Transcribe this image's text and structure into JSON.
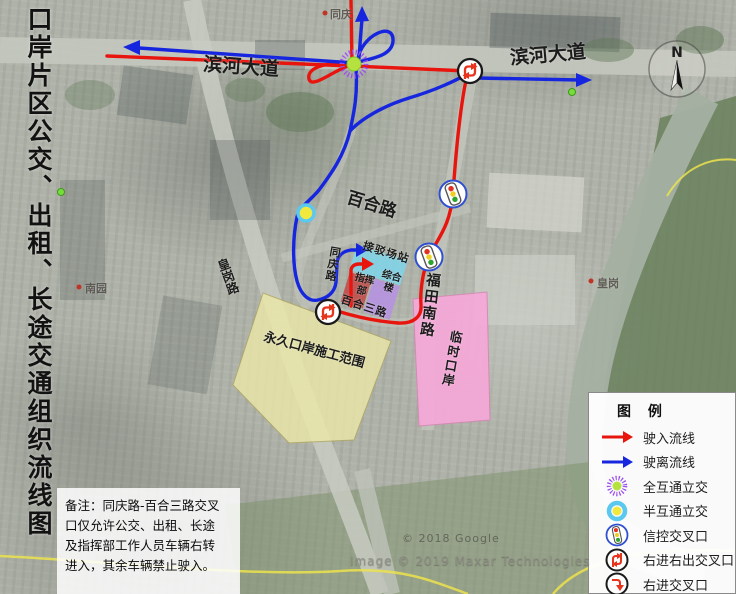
{
  "title": {
    "text": "口岸片区公交、出租、长途交通组织流线图"
  },
  "roads": {
    "binhe_west": "滨河大道",
    "binhe_east": "滨河大道",
    "baihe": "百合路",
    "futian_south": "福田南路",
    "tongqing": "同庆路",
    "huanggang": "皇岗路",
    "baihe3": "百合三路"
  },
  "zones": {
    "station": "接驳场站",
    "command": "指挥部",
    "complex_building": "综合楼",
    "permanent_port": "永久口岸施工范围",
    "temporary_port": "临时口岸"
  },
  "places": {
    "tongqing": "同庆",
    "huanggang": "皇岗",
    "nanyuan": "南园"
  },
  "note": {
    "lines": [
      "备注：同庆路-百合三路交叉",
      "口仅允许公交、出租、长途",
      "及指挥部工作人员车辆右转",
      "进入，其余车辆禁止驶入。"
    ]
  },
  "legend": {
    "title": "图 例",
    "items": [
      {
        "icon": "inbound-arrow",
        "label": "驶入流线"
      },
      {
        "icon": "outbound-arrow",
        "label": "驶离流线"
      },
      {
        "icon": "full-interchange",
        "label": "全互通立交"
      },
      {
        "icon": "half-interchange",
        "label": "半互通立交"
      },
      {
        "icon": "signal-intersection",
        "label": "信控交叉口"
      },
      {
        "icon": "right-in-right-out",
        "label": "右进右出交叉口"
      },
      {
        "icon": "right-in",
        "label": "右进交叉口"
      }
    ]
  },
  "compass": {
    "label": "N"
  },
  "watermarks": {
    "google": "© 2018 Google",
    "maxar": "Image © 2019 Maxar Technologies"
  },
  "colors": {
    "inbound": "#e8150e",
    "outbound": "#1626df",
    "full_interchange_ring": "#9b4ff0",
    "full_interchange_core": "#b5e23e",
    "half_interchange_ring": "#5bc8f0",
    "half_interchange_core": "#f2e93f",
    "permanent_port_fill": "#eeeaa8",
    "temporary_port_fill": "#f6a8d8",
    "station_fill": "#7fd4e8",
    "command_fill": "#c0504d",
    "complex_fill": "#b694e0"
  }
}
